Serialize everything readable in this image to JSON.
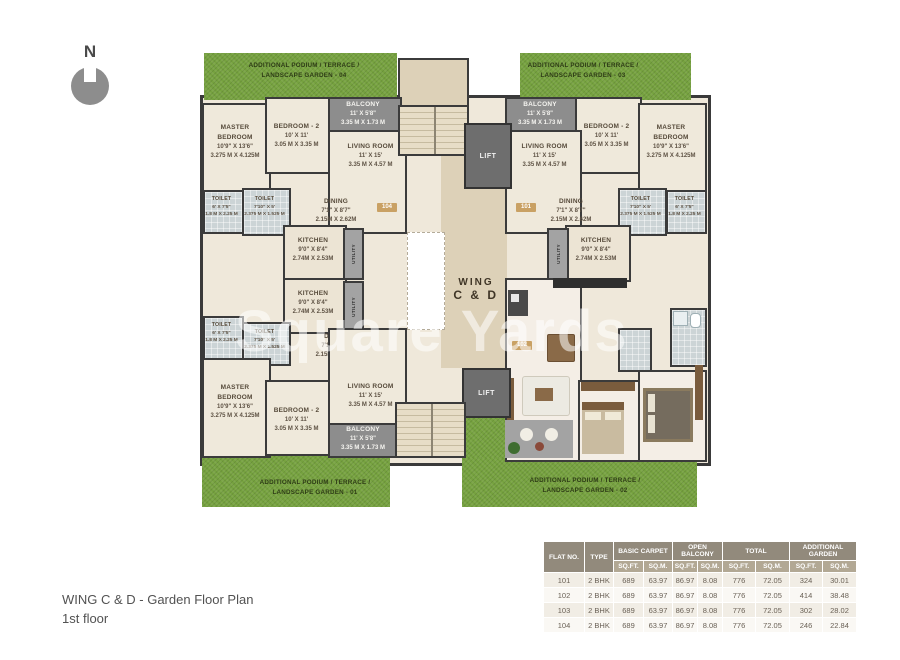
{
  "north": {
    "label": "N"
  },
  "caption": {
    "line1": "WING C & D -  Garden Floor Plan",
    "line2": "1st floor"
  },
  "watermark": "Square Yards",
  "core": {
    "wing_line1": "WING",
    "wing_line2": "C & D",
    "lift": "LIFT"
  },
  "gardens": {
    "top_left_line1": "ADDITIONAL PODIUM / TERRACE /",
    "top_left_line2": "LANDSCAPE GARDEN - 04",
    "top_right_line1": "ADDITIONAL PODIUM / TERRACE /",
    "top_right_line2": "LANDSCAPE GARDEN - 03",
    "bottom_left_line1": "ADDITIONAL PODIUM / TERRACE /",
    "bottom_left_line2": "LANDSCAPE GARDEN - 01",
    "bottom_right_line1": "ADDITIONAL PODIUM / TERRACE /",
    "bottom_right_line2": "LANDSCAPE GARDEN - 02"
  },
  "rooms": {
    "master_bedroom": {
      "name": "MASTER BEDROOM",
      "ft": "10'9\" X 13'6\"",
      "m": "3.275 M X 4.125M"
    },
    "bedroom2": {
      "name": "BEDROOM - 2",
      "ft": "10' X 11'",
      "m": "3.05 M X 3.35 M"
    },
    "balcony": {
      "name": "BALCONY",
      "ft": "11' X 5'8\"",
      "m": "3.35 M X 1.73 M"
    },
    "living_room": {
      "name": "LIVING ROOM",
      "ft": "11' X 15'",
      "m": "3.35 M X 4.57 M"
    },
    "dining": {
      "name": "DINING",
      "ft": "7'1\" X 8'7\"",
      "m": "2.15M X 2.62M"
    },
    "kitchen": {
      "name": "KITCHEN",
      "ft": "9'0\" X 8'4\"",
      "m": "2.74M X 2.53M"
    },
    "toilet_a": {
      "name": "TOILET",
      "ft": "6' X 7'5\"",
      "m": "1.8 M X 2.25 M"
    },
    "toilet_b": {
      "name": "TOILET",
      "ft": "7'10\" X 5'",
      "m": "2.375 M X 1.525 M"
    },
    "utility": {
      "name": "UTILITY",
      "ft": "3'0\" X 8'4\"",
      "m": "0.90M X 2.53M"
    }
  },
  "badges": {
    "f101": "101",
    "f102": "102",
    "f103": "103",
    "f104": "104"
  },
  "colors": {
    "garden_green": "#76a23f",
    "wall": "#3a3a3a",
    "floor_cream": "#efe8da",
    "lobby_tan": "#ddd1b8",
    "badge_gold": "#c9a164",
    "balcony_gray": "#8d8d8d",
    "table_header": "#928a7c",
    "table_subheader": "#b2a894"
  },
  "table": {
    "groups": [
      "FLAT NO.",
      "TYPE",
      "BASIC CARPET",
      "OPEN BALCONY",
      "TOTAL",
      "ADDITIONAL GARDEN"
    ],
    "sub": [
      "SQ.FT.",
      "SQ.M."
    ],
    "rows": [
      [
        "101",
        "2 BHK",
        "689",
        "63.97",
        "86.97",
        "8.08",
        "776",
        "72.05",
        "324",
        "30.01"
      ],
      [
        "102",
        "2 BHK",
        "689",
        "63.97",
        "86.97",
        "8.08",
        "776",
        "72.05",
        "414",
        "38.48"
      ],
      [
        "103",
        "2 BHK",
        "689",
        "63.97",
        "86.97",
        "8.08",
        "776",
        "72.05",
        "302",
        "28.02"
      ],
      [
        "104",
        "2 BHK",
        "689",
        "63.97",
        "86.97",
        "8.08",
        "776",
        "72.05",
        "246",
        "22.84"
      ]
    ]
  }
}
